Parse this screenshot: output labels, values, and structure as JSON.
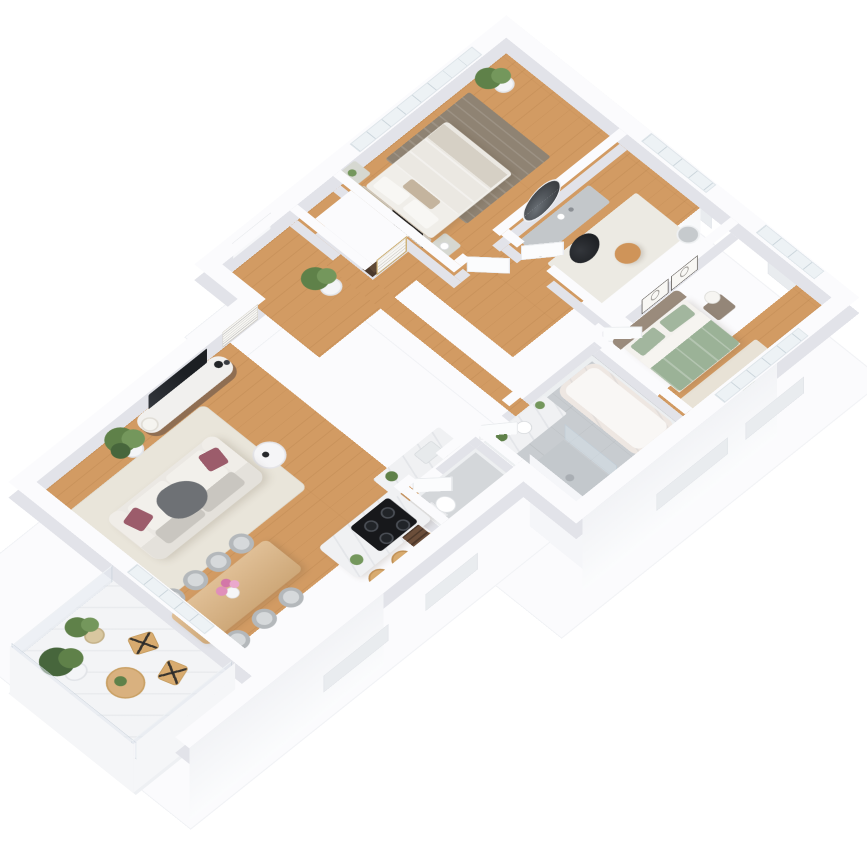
{
  "scene": {
    "description": "White 3D isometric floor-plan render of an apartment with oak floors, viewed from above at a 45-degree rotation on a plain white background",
    "background": "#ffffff",
    "projection": {
      "rotateX_deg": 37,
      "rotateZ_deg": -45,
      "wall_height_px": 26
    }
  },
  "palette": {
    "wall_top": "#fbfbfd",
    "wall_shade": "#e2e3e9",
    "exterior_face": "#f7f8fa",
    "floor_wood": "#d29b63",
    "bathroom_tile": "#c8ccd0",
    "wc_tile": "#d4d7da",
    "balcony_floor": "#f3f4f6",
    "marble": "#f0f1f3",
    "glass": "#dde6ed",
    "door_white": "#f7f8fa",
    "rug_living": "#e9e5da",
    "rug_master": "#8f8373",
    "rug_beige": "#e8e2d6",
    "sofa": "#ebe8e3",
    "cushion_gray": "#c9c6c0",
    "pillow_maroon": "#9c5c6b",
    "throw_gray": "#6e7175",
    "tv_black": "#26292d",
    "console_wood": "#8f6e52",
    "table_wood": "#d9b17f",
    "chair_gray": "#b4b8bb",
    "stool_wood": "#d8ab6f",
    "cooktop_black": "#17181b",
    "bed_white": "#f0eee9",
    "accent_pillow_tan": "#c4b49e",
    "headboard_taupe": "#9a8b7c",
    "duvet_green": "#9bb297",
    "pillow_green": "#a2b69e",
    "plant_green": "#5f8149",
    "plant_dark": "#47663c",
    "plant_light": "#74975c",
    "pot_white": "#f4f5f7",
    "pot_wicker": "#d8c7a0",
    "tub_cream": "#eee7e2",
    "radiator_brown": "#6b4e3a",
    "flower_pink": "#e08fba",
    "frame_gold": "#c9a96a",
    "frame_dark": "#2f2b28",
    "frame_beige": "#ccbfa6",
    "vanity_gray": "#c3c7ca",
    "pouf_tan": "#cf9459",
    "nightstand_sage": "#d6d8d1"
  },
  "rooms": [
    {
      "name": "entry-hall",
      "floor": "wood",
      "furniture": [
        "front-door",
        "potted-plant"
      ]
    },
    {
      "name": "master-bedroom",
      "floor": "wood",
      "furniture": [
        "double-bed",
        "nightstand-left",
        "nightstand-right",
        "wall-art-beige",
        "wall-art-dark",
        "striped-area-rug",
        "palm-plant",
        "window"
      ]
    },
    {
      "name": "dressing-room",
      "floor": "wood",
      "furniture": [
        "vanity-desk",
        "round-mirror",
        "black-chair",
        "tan-pouf",
        "basket",
        "rug",
        "window"
      ]
    },
    {
      "name": "second-bedroom",
      "floor": "wood",
      "furniture": [
        "bed-green-duvet",
        "taupe-headboard",
        "nightstand",
        "ball-lamp",
        "line-art-frame",
        "line-art-frame",
        "beige-rug",
        "green-pouf",
        "windows"
      ]
    },
    {
      "name": "bathroom",
      "floor": "gray-tile",
      "walls": "marble",
      "furniture": [
        "bathtub",
        "shower",
        "glass-screen",
        "marble-vanity",
        "towel-radiator",
        "plants"
      ]
    },
    {
      "name": "wc",
      "floor": "gray-tile",
      "furniture": [
        "toilet",
        "open-door"
      ]
    },
    {
      "name": "hallway",
      "floor": "wood",
      "furniture": [
        "wardrobe-niche-with-clothes",
        "gold-framed-art"
      ]
    },
    {
      "name": "living-room",
      "floor": "wood",
      "furniture": [
        "sofa-white",
        "maroon-pillows",
        "gray-throw",
        "tv",
        "tv-console-wood-marble",
        "floor-lamp",
        "black-vases",
        "wall-art",
        "beige-rug",
        "round-side-table",
        "large-plant"
      ]
    },
    {
      "name": "dining-area",
      "floor": "wood",
      "furniture": [
        "wood-dining-table",
        "gray-chairs-x7",
        "pink-flower-vase"
      ]
    },
    {
      "name": "kitchen",
      "floor": "wood",
      "furniture": [
        "marble-island",
        "induction-cooktop",
        "bar-stools-x3",
        "marble-counter",
        "sink",
        "wood-radiator",
        "plants"
      ]
    },
    {
      "name": "balcony",
      "floor": "white-deck",
      "furniture": [
        "glass-railing",
        "bush-plant-white-pot",
        "bush-plant-wicker-pot",
        "round-wood-table",
        "folding-chairs-x2",
        "small-plant"
      ]
    }
  ]
}
